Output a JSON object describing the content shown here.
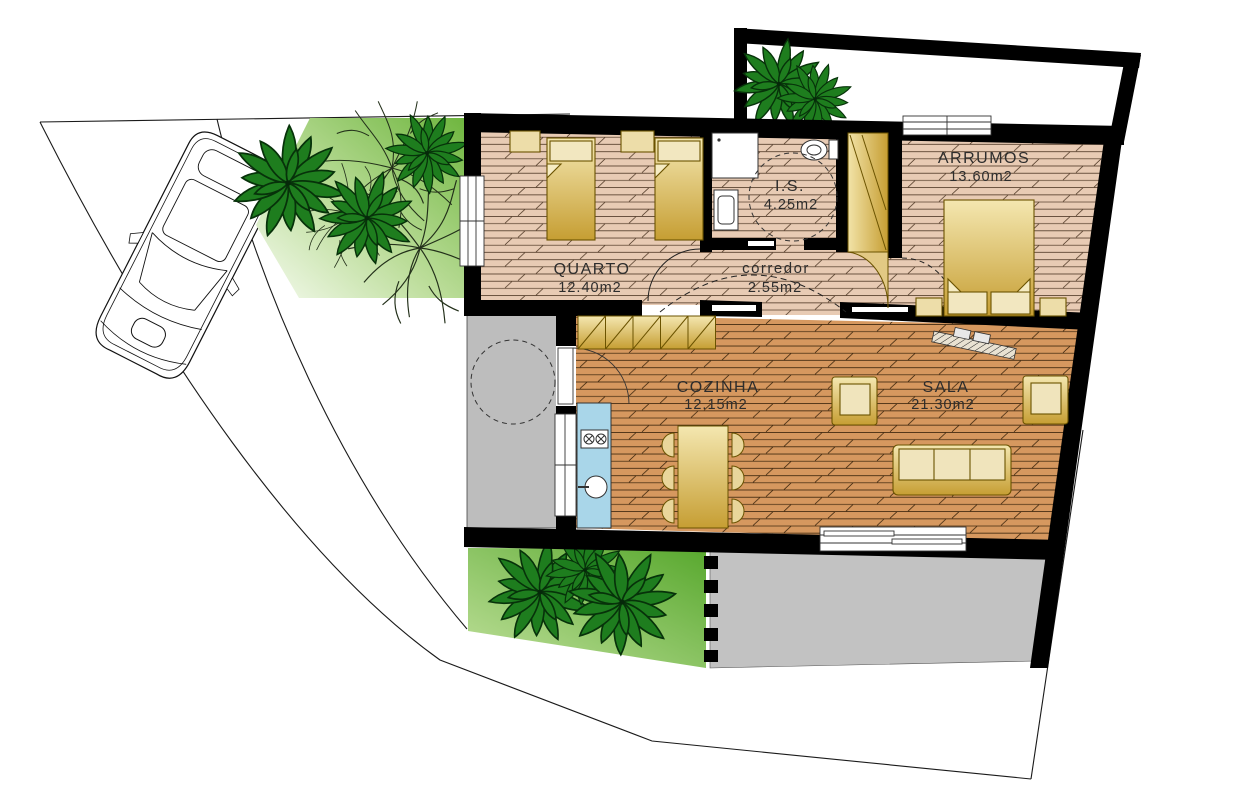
{
  "title": "Residential floor plan",
  "rooms": [
    {
      "id": "quarto",
      "name": "QUARTO",
      "area": "12.40m2"
    },
    {
      "id": "is",
      "name": "I.S.",
      "area": "4.25m2"
    },
    {
      "id": "corredor",
      "name": "corredor",
      "area": "2.55m2"
    },
    {
      "id": "arrumos",
      "name": "ARRUMOS",
      "area": "13.60m2"
    },
    {
      "id": "cozinha",
      "name": "COZINHA",
      "area": "12.15m2"
    },
    {
      "id": "sala",
      "name": "SALA",
      "area": "21.30m2"
    }
  ],
  "palette": {
    "wall": "#000000",
    "floor_light": "#E8CBB4",
    "floor_dark": "#D6985F",
    "furniture_gold_light": "#F4E7B0",
    "furniture_gold_dark": "#C69E33",
    "counter_blue": "#A9D6E9",
    "patio_gray": "#BDBDBD",
    "terrace_gray": "#C2C2C2",
    "garden_green": "#5FAE33",
    "palm_green": "#1E7D1E"
  },
  "objects": {
    "vehicle": "car",
    "vegetation": [
      "palm-tree",
      "shrub"
    ],
    "fixtures": [
      "shower",
      "washbasin",
      "toilet",
      "stove",
      "sink",
      "front-door",
      "sliding-door",
      "window"
    ],
    "furniture": [
      "single-bed",
      "double-bed",
      "nightstand",
      "wardrobe",
      "kitchen-cabinets",
      "dining-table",
      "chair",
      "sofa",
      "armchair",
      "sideboard"
    ]
  }
}
